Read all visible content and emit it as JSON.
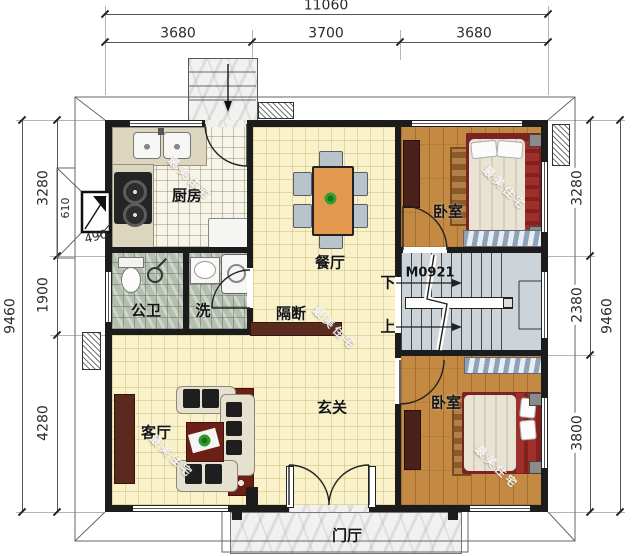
{
  "watermark": {
    "text": "最美住宅"
  },
  "dimensions": {
    "top_total": "11060",
    "top_segments": [
      "3680",
      "3700",
      "3680"
    ],
    "left_total": "9460",
    "left_segments": [
      "3280",
      "1900",
      "4280"
    ],
    "right_total": "9460",
    "right_segments": [
      "3280",
      "2380",
      "3800"
    ],
    "flue_width": "490",
    "flue_depth": "610"
  },
  "rooms": {
    "kitchen": "厨房",
    "dining": "餐厅",
    "bedroom_top": "卧室",
    "bathroom": "公卫",
    "wash": "洗",
    "partition": "隔断",
    "foyer": "玄关",
    "living": "客厅",
    "bedroom_bottom": "卧室",
    "porch": "门厅"
  },
  "stairs": {
    "door_code": "M0921",
    "down": "下",
    "up": "上"
  },
  "colors": {
    "wall": "#1c1c1c",
    "floor_yellow": "#f8f1c9",
    "wood": "#c48a43",
    "bath_tile": "#b5bfb0",
    "partition_wood": "#5b2b20",
    "table_orange": "#e2984e",
    "bed_frame_red": "#7a2322",
    "stair_gray": "#cdd4d9",
    "marble": "#f2f1ef"
  }
}
